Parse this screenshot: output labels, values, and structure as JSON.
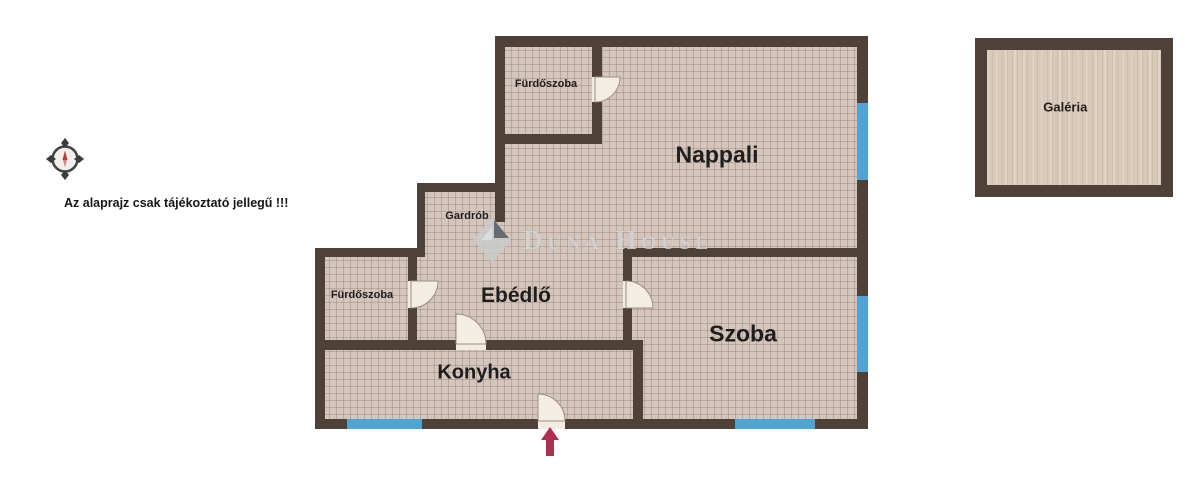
{
  "page": {
    "background_color": "#ffffff"
  },
  "annotations": {
    "disclaimer_text": "Az alaprajz csak tájékoztató jellegű !!!",
    "compass_icon": "compass-rose",
    "entrance_arrow_icon": "entrance-direction-up"
  },
  "watermark": {
    "logo_icon": "duna-house-diamond",
    "text": "Duna House"
  },
  "floorplan": {
    "rooms": [
      {
        "id": "furdoszoba-top",
        "label": "Fürdőszoba"
      },
      {
        "id": "nappali",
        "label": "Nappali"
      },
      {
        "id": "gardrob",
        "label": "Gardrób"
      },
      {
        "id": "furdoszoba-left",
        "label": "Fürdőszoba"
      },
      {
        "id": "ebedlo",
        "label": "Ebédlő"
      },
      {
        "id": "szoba",
        "label": "Szoba"
      },
      {
        "id": "konyha",
        "label": "Konyha"
      },
      {
        "id": "galeria",
        "label": "Galéria"
      }
    ],
    "features": {
      "door_count": 5,
      "window_count": 4
    },
    "colors": {
      "wall": "#4e4238",
      "floor": "#d4c6bc",
      "floor_grid": "#80644e",
      "window": "#4fa5d2",
      "door_leaf": "#f4ede4",
      "galeria_floor": "#d8c9b8",
      "entrance_arrow": "#b12d52",
      "label_text": "#1e1e1e"
    }
  }
}
